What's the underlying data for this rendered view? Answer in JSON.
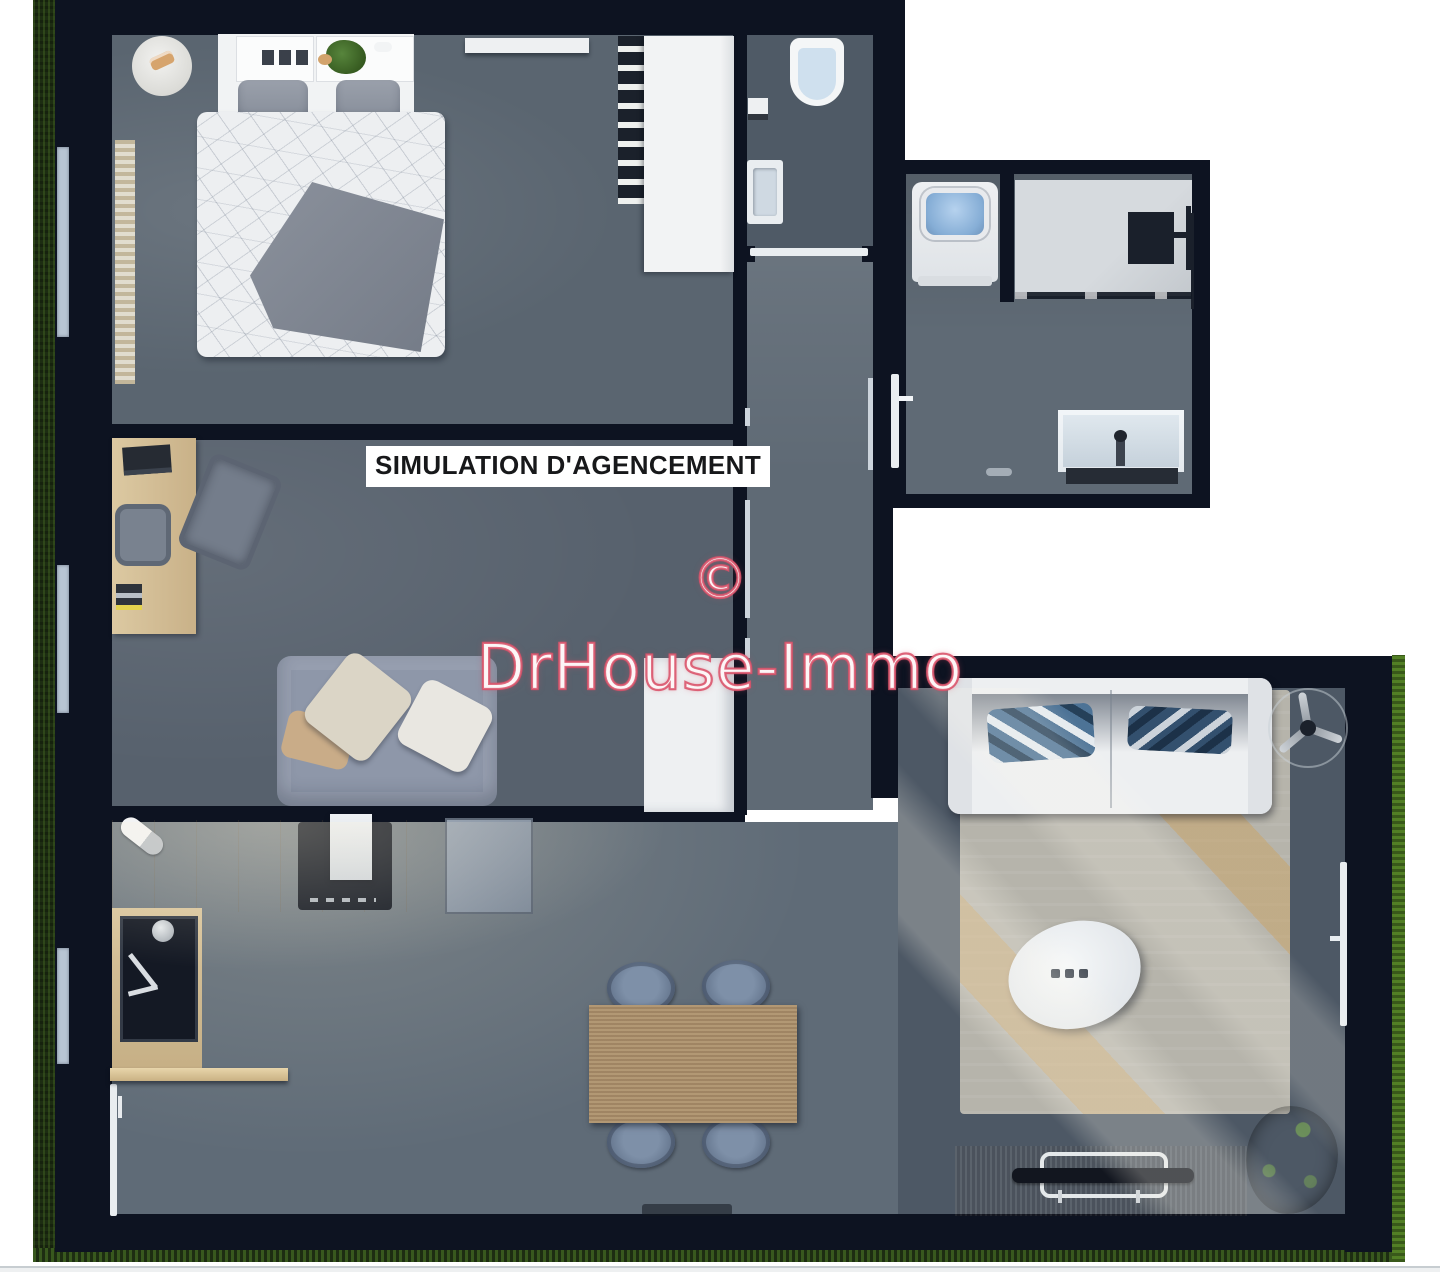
{
  "meta": {
    "width_px": 1440,
    "height_px": 1272,
    "kind": "3d-floor-plan-render"
  },
  "overlay": {
    "label": "SIMULATION D'AGENCEMENT",
    "copyright_symbol": "©",
    "brand": "DrHouse-Immo"
  },
  "palette": {
    "background": "#ffffff",
    "wall": "#0d1321",
    "grass_dark": "#1d2d12",
    "grass_bright": "#527f25",
    "floor_bedroom": "#5a6570",
    "floor_office": "#57616d",
    "floor_hall": "#5f6a75",
    "floor_wc": "#4f5a66",
    "floor_kitchen": "#5f6b77",
    "floor_living": "#4d5865",
    "wood_light": "#d7c29a",
    "wood_mid": "#a98e6b",
    "wood_dark": "#8a6d4e",
    "white_furniture": "#eef0f2",
    "sofa_grey": "#8e97a9",
    "watermark_red": "#d9526a",
    "label_text": "#17181a"
  },
  "scene": {
    "rooms": [
      {
        "name": "bedroom",
        "furniture": [
          "double-bed",
          "grey-throw-blanket",
          "pillows",
          "nightstands",
          "headboard",
          "round-rug",
          "radiator",
          "clothes-rack",
          "wardrobe",
          "wall-shelf",
          "plant",
          "lamp"
        ]
      },
      {
        "name": "wc",
        "furniture": [
          "toilet",
          "toilet-paper-holder",
          "hand-basin",
          "door"
        ]
      },
      {
        "name": "hallway",
        "furniture": [
          "door-frames"
        ]
      },
      {
        "name": "bathroom-laundry",
        "furniture": [
          "washing-machine",
          "walk-in-shower",
          "vanity-sink",
          "door"
        ]
      },
      {
        "name": "office",
        "furniture": [
          "desk",
          "laptop",
          "desk-chair",
          "lounge-chair",
          "books",
          "grey-sofa",
          "throw-pillows",
          "cupboard"
        ]
      },
      {
        "name": "kitchen-dining",
        "furniture": [
          "counter",
          "cooktop",
          "towel",
          "appliance-cabinet",
          "sink",
          "faucet",
          "shelf",
          "dining-table",
          "four-chairs",
          "doormat",
          "open-door"
        ]
      },
      {
        "name": "living-room",
        "furniture": [
          "white-sofa",
          "blue-pillows",
          "ceiling-fan",
          "area-rug",
          "oval-coffee-table",
          "tv-stand",
          "flat-tv",
          "plant",
          "terrace-door"
        ]
      }
    ],
    "exterior": [
      "grass-strip-left",
      "grass-strip-bottom",
      "grass-strip-right"
    ]
  }
}
